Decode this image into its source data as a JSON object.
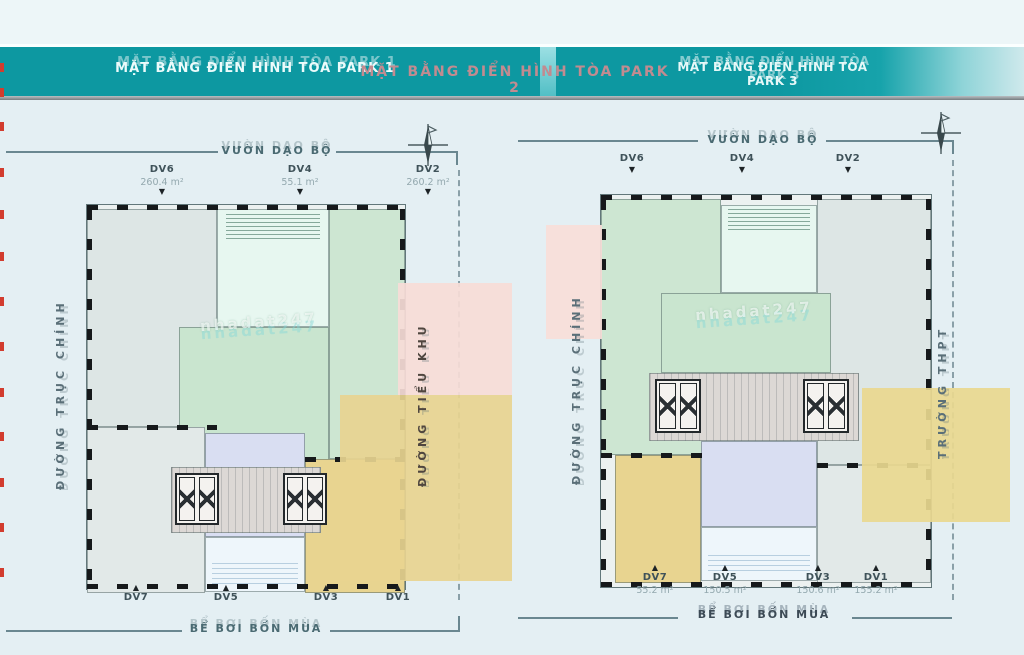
{
  "page": {
    "background": "#e4eff3",
    "header_strip": "#edf6f8"
  },
  "header": {
    "bar_color": "#0d98a1",
    "underline_color": "#767d81",
    "titles": [
      {
        "text": "MẶT BẰNG ĐIỂN HÌNH TÒA PARK 1",
        "color": "#ecfbfb"
      },
      {
        "text": "MẶT BẰNG ĐIỂN HÌNH TÒA PARK 2",
        "color": "#c28b90"
      },
      {
        "text": "MẶT BẰNG ĐIỂN HÌNH TÒA PARK 3",
        "color": "#e6f8f8"
      }
    ]
  },
  "plans": [
    {
      "id": "plan-left",
      "top_label": "VƯỜN DẠO BỘ",
      "bottom_label": "BỂ BƠI BỐN MÙA",
      "left_label": "ĐƯỜNG TRỤC CHÍNH",
      "right_label": "ĐƯỜNG TIỂU KHU",
      "watermark": "nhadat247",
      "compass_icon": "compass-north-icon",
      "top_units": [
        {
          "id": "DV6",
          "area": "260.4 m²"
        },
        {
          "id": "DV4",
          "area": "55.1 m²"
        },
        {
          "id": "DV2",
          "area": "260.2 m²"
        }
      ],
      "bottom_units": [
        {
          "id": "DV7",
          "area": ""
        },
        {
          "id": "DV5",
          "area": ""
        },
        {
          "id": "DV3",
          "area": ""
        },
        {
          "id": "DV1",
          "area": ""
        }
      ]
    },
    {
      "id": "plan-right",
      "top_label": "VƯỜN DẠO BỘ",
      "bottom_label": "BỂ BƠI BỐN MÙA",
      "left_label": "ĐƯỜNG TRỤC CHÍNH",
      "right_label": "TRƯỜNG THPT",
      "watermark": "nhadat247",
      "compass_icon": "compass-north-icon",
      "top_units": [
        {
          "id": "DV6",
          "area": ""
        },
        {
          "id": "DV4",
          "area": ""
        },
        {
          "id": "DV2",
          "area": ""
        }
      ],
      "bottom_units": [
        {
          "id": "DV7",
          "area": "55.2 m²"
        },
        {
          "id": "DV5",
          "area": "150.5 m²"
        },
        {
          "id": "DV3",
          "area": "150.6 m²"
        },
        {
          "id": "DV1",
          "area": "155.2 m²"
        }
      ]
    }
  ],
  "palette": {
    "unit_green": "#c9e5cf",
    "unit_mint": "#e7f7f0",
    "unit_gray": "#dde6e5",
    "unit_lavender": "#d9def2",
    "unit_yellow": "#e8d490",
    "band_pink": "#f7dcd7",
    "pool_blue": "#eef6fb",
    "corridor_gray": "#dcd8d5",
    "wall_dark": "#16191b",
    "label_teal": "#4a6a72",
    "edge_red": "#d23c2e"
  }
}
